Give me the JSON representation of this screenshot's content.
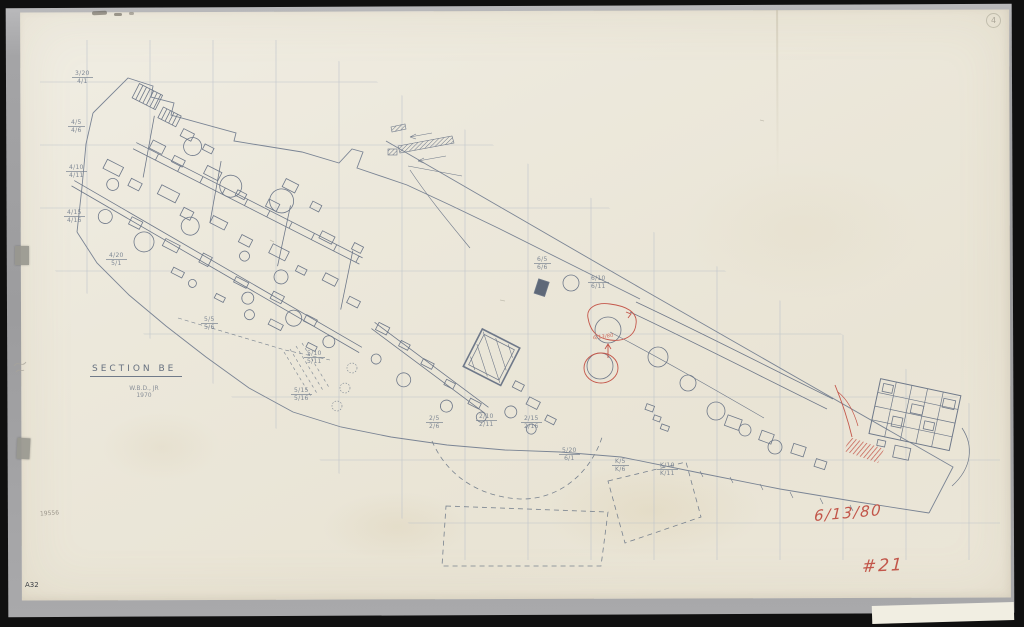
{
  "scan": {
    "description": "Hand-drawn archaeological excavation site plan, scanned sheet on gray board",
    "paper_color": "#ebe7da",
    "ink_color": "#6e7889",
    "grid_color": "#b8bfc8",
    "red_color": "#c2564a"
  },
  "labels": {
    "section_title": "SECTION BE",
    "credit_name": "W.B.D., JR",
    "credit_year": "1970",
    "catalog_number": "19556",
    "sheet_code": "A32",
    "corner_mark": "4"
  },
  "annotations": {
    "red_date": "6/13/80",
    "red_sheet_number": "#21",
    "red_feature_note": "6/13/80"
  },
  "plan": {
    "grid_labels": [
      {
        "top": "3/20",
        "bottom": "4/1"
      },
      {
        "top": "4/5",
        "bottom": "4/6"
      },
      {
        "top": "4/10",
        "bottom": "4/11"
      },
      {
        "top": "4/15",
        "bottom": "4/16"
      },
      {
        "top": "4/20",
        "bottom": "5/1"
      },
      {
        "top": "5/5",
        "bottom": "5/6"
      },
      {
        "top": "5/10",
        "bottom": "5/11"
      },
      {
        "top": "5/15",
        "bottom": "5/16"
      },
      {
        "top": "2/5",
        "bottom": "2/6"
      },
      {
        "top": "2/10",
        "bottom": "2/11"
      },
      {
        "top": "2/15",
        "bottom": "2/16"
      },
      {
        "top": "5/20",
        "bottom": "6/1"
      },
      {
        "top": "K/5",
        "bottom": "K/6"
      },
      {
        "top": "K/10",
        "bottom": "K/11"
      },
      {
        "top": "6/5",
        "bottom": "6/6"
      },
      {
        "top": "6/10",
        "bottom": "6/11"
      }
    ]
  }
}
